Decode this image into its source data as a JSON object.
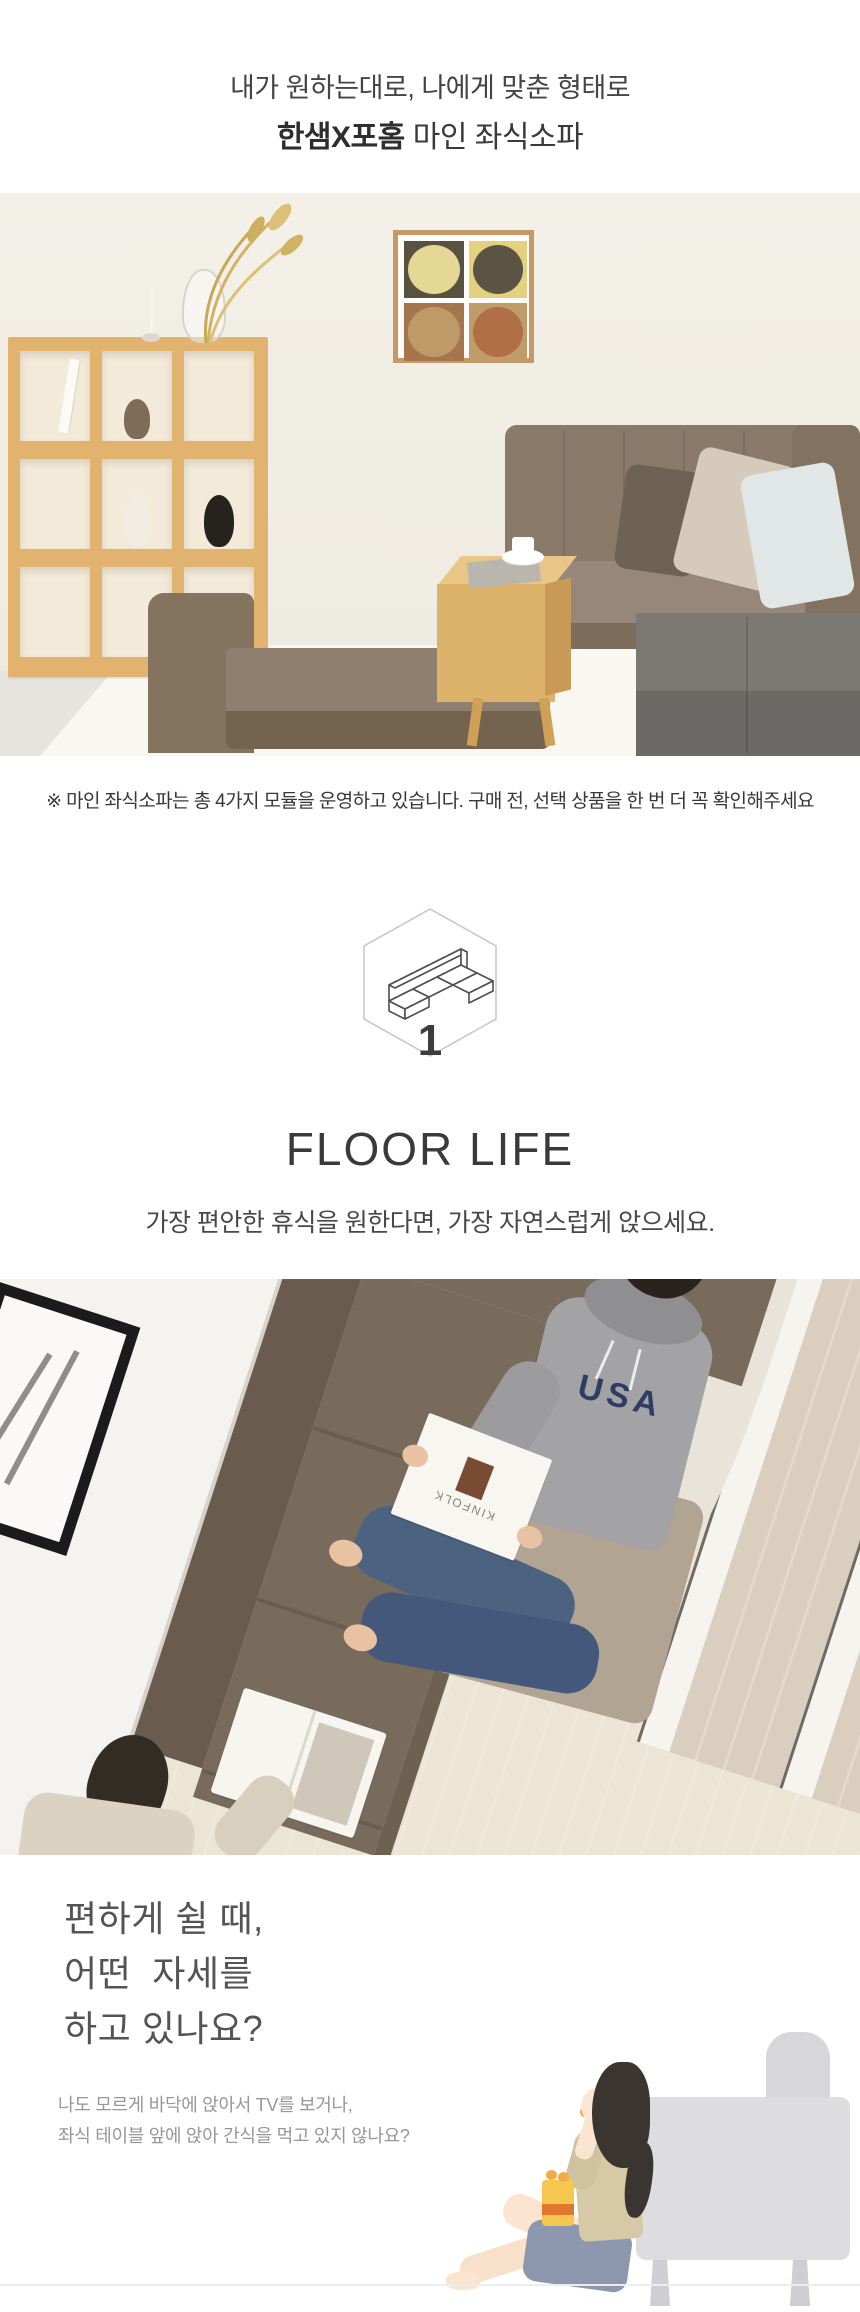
{
  "header": {
    "tagline": "내가 원하는대로, 나에게 맞춘 형태로",
    "brand": "한샘X포홈",
    "product": "마인 좌식소파"
  },
  "notice": "※ 마인 좌식소파는 총 4가지 모듈을 운영하고 있습니다. 구매 전, 선택 상품을 한 번 더 꼭 확인해주세요",
  "module_badge": {
    "number": "1",
    "icon": "sofa-module-isometric-icon"
  },
  "floor_life": {
    "title": "FLOOR LIFE",
    "subtitle": "가장 편안한 휴식을 원한다면, 가장 자연스럽게 앉으세요."
  },
  "question": {
    "line1": "편하게 쉴 때,",
    "line2": "어떤  자세를",
    "line3": "하고 있나요?"
  },
  "description": {
    "line1": "나도 모르게 바닥에 앉아서 TV를 보거나,",
    "line2": "좌식 테이블 앞에 앉아 간식을 먹고 있지 않나요?"
  },
  "photos": {
    "lifestyle": {
      "hoodie_text": "USA",
      "magazine_text": "KINFOLK"
    }
  },
  "colors": {
    "text_dark": "#3a3a3a",
    "text_gray": "#979797",
    "sofa_brown": "#8a7a6a",
    "sofa_gray": "#7b7974",
    "wood": "#e2b36e",
    "illustration_sofa": "#dddde0",
    "snack_bag_yellow": "#f7c64e",
    "shorts_blue": "#8d97ad"
  }
}
